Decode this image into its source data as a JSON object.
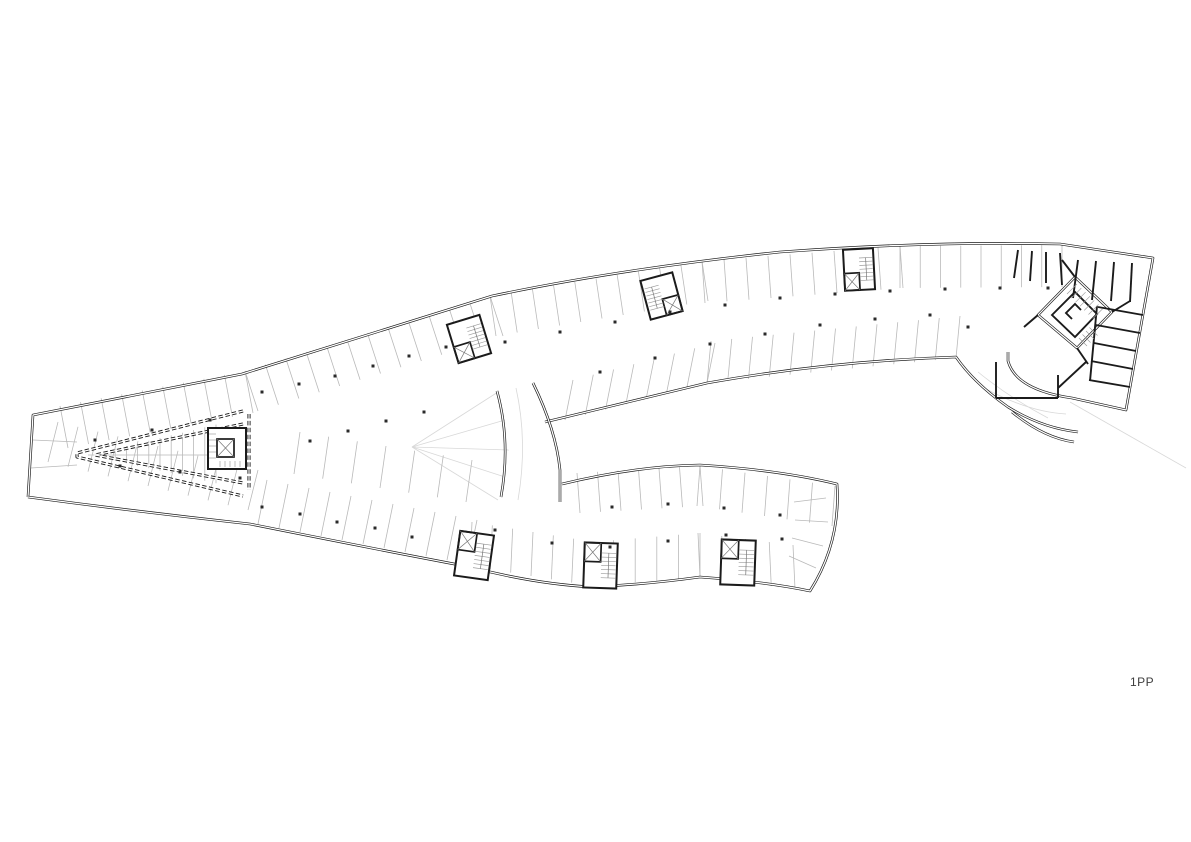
{
  "plan": {
    "label": "1PP",
    "colors": {
      "background": "#ffffff",
      "wall": "#1b1b1b",
      "stall": "#b9b9b9",
      "faint": "#d8d8d8",
      "hatch": "#9a9a9a",
      "column": "#2a2a2a",
      "label": "#3d3d3d"
    }
  }
}
